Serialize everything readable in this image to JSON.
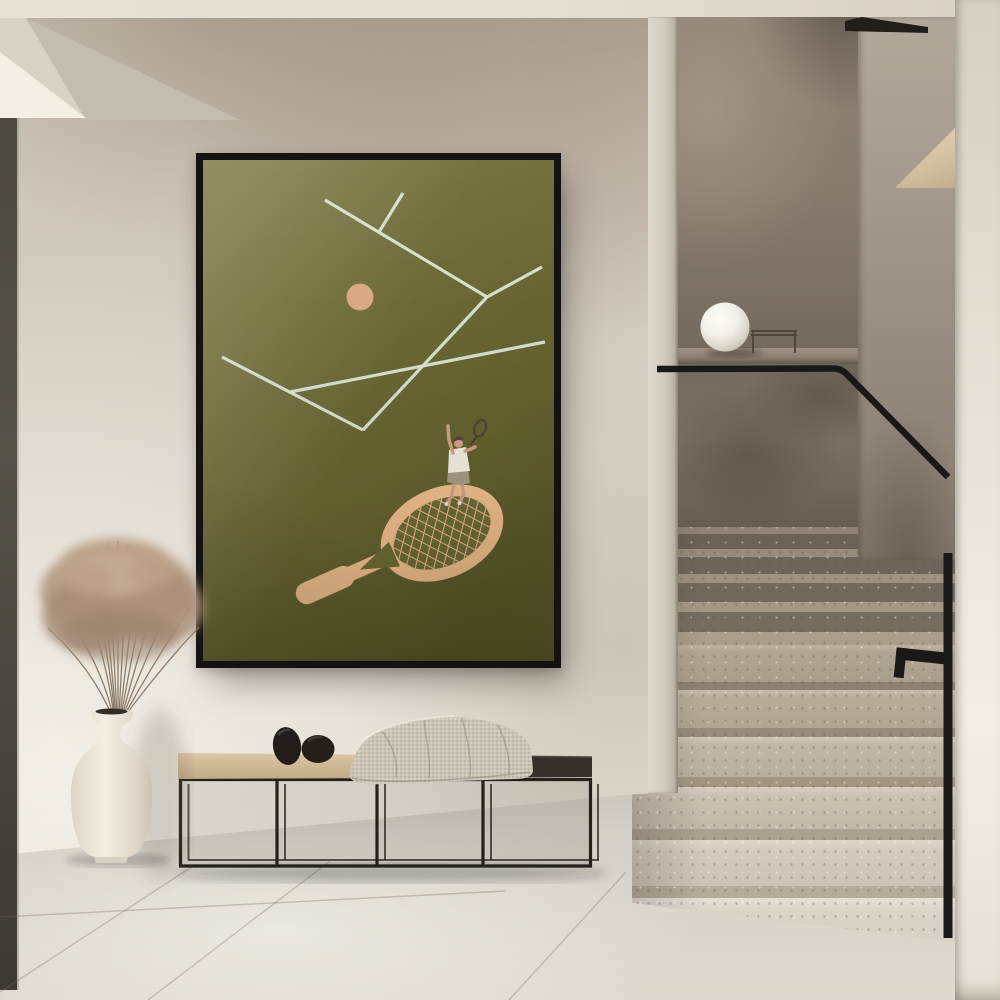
{
  "scene": {
    "description": "Minimalist hallway interior: framed tennis art print on a plaster wall, black metal bench with pebble sculptures and a knit throw, cream vase with dried pampas grass, and a terrazzo staircase with black handrail and white globe lamp",
    "poster": {
      "alt": "Framed minimalist tennis poster: olive green court with pale lines, tiny serving player standing on a large peach tennis racket, peach ball",
      "subject_icons": [
        "tennis-player-icon",
        "tennis-racket-icon",
        "tennis-ball-icon",
        "court-lines"
      ]
    },
    "bench": {
      "alt": "Low black metal frame bench, half oak seat and half dark seat, two black pebble objects and a draped knit blanket"
    },
    "vase": {
      "alt": "Cream ceramic vase with dried pampas grass stems"
    },
    "stairs": {
      "alt": "Terrazzo stone staircase turning upward with black handrail and concrete parapet"
    },
    "lamp": {
      "alt": "White globe lamp on concrete ledge at stair landing"
    },
    "floor": {
      "alt": "Large-format light grey stone tile floor"
    }
  },
  "colors": {
    "poster-frame": "#151311",
    "poster-green": "#6c6a36",
    "poster-green-dark": "#585626",
    "court-line": "#dce4d6",
    "racket": "#ecbb8b",
    "ball": "#d9a57f",
    "skin": "#cda188",
    "shirt": "#f1ebde",
    "shorts": "#a39a85",
    "hair": "#57453c",
    "bench-wood": "#d5bc9b",
    "bench-dark": "#36302a",
    "metal": "#24211d",
    "pebble": "#201d1a",
    "blanket": "#ccc5b7",
    "vase": "#f0eadd",
    "grass": "#b19780",
    "stair-wall": "#847968",
    "parapet": "#6f6557",
    "side-wall": "#a49a8c",
    "stair-wedge": "#dcc8a8",
    "column": "#ece7dc",
    "step-light": "#dad3c7",
    "step-mid": "#a99d8c",
    "rail": "#1b1917",
    "lamp": "#f4f1ea",
    "wall-light": "#e3ded3",
    "wall-stain": "#9c8d7d",
    "floor": "#d6d2c9",
    "left-strip": "#45423a",
    "ceiling": "#e5dfd3"
  }
}
